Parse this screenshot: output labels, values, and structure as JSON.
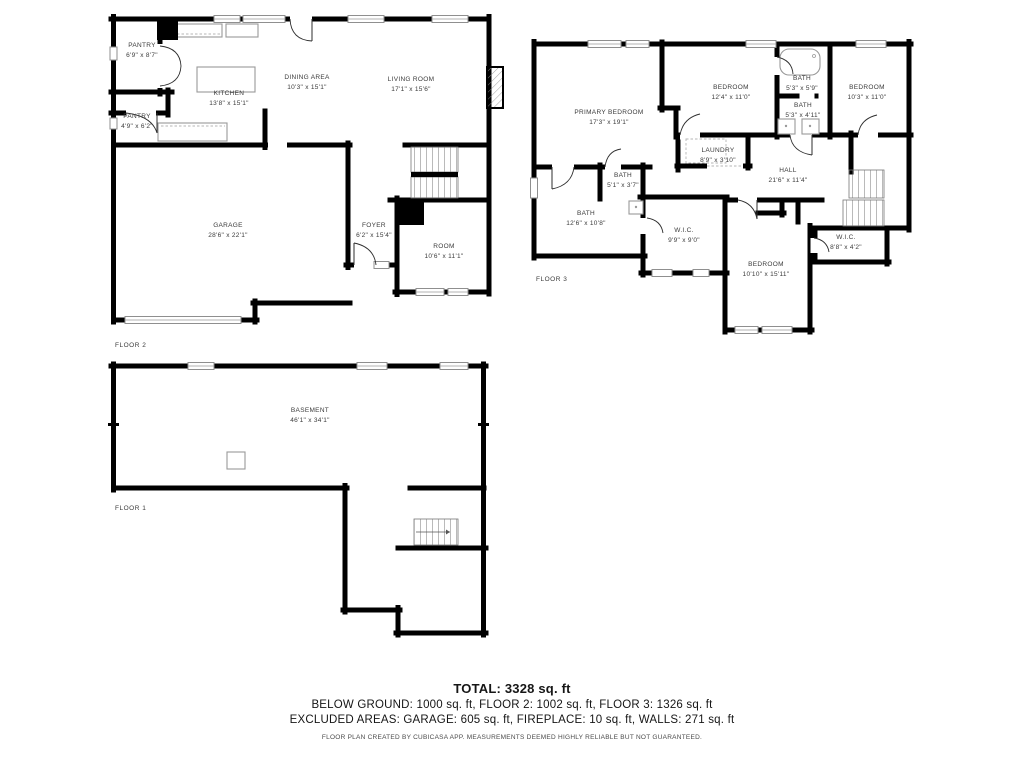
{
  "floors": [
    {
      "label": "FLOOR 2",
      "rooms": [
        {
          "name": "PANTRY",
          "dims": "6'9\" x 8'7\""
        },
        {
          "name": "PANTRY",
          "dims": "4'9\" x 6'2\""
        },
        {
          "name": "KITCHEN",
          "dims": "13'8\" x 15'1\""
        },
        {
          "name": "DINING AREA",
          "dims": "10'3\" x 15'1\""
        },
        {
          "name": "LIVING ROOM",
          "dims": "17'1\" x 15'6\""
        },
        {
          "name": "GARAGE",
          "dims": "28'6\" x 22'1\""
        },
        {
          "name": "FOYER",
          "dims": "6'2\" x 15'4\""
        },
        {
          "name": "ROOM",
          "dims": "10'6\" x 11'1\""
        }
      ]
    },
    {
      "label": "FLOOR 3",
      "rooms": [
        {
          "name": "PRIMARY BEDROOM",
          "dims": "17'3\" x 19'1\""
        },
        {
          "name": "BEDROOM",
          "dims": "12'4\" x 11'0\""
        },
        {
          "name": "BATH",
          "dims": "5'3\" x 5'9\""
        },
        {
          "name": "BATH",
          "dims": "5'3\" x 4'11\""
        },
        {
          "name": "BEDROOM",
          "dims": "10'3\" x 11'0\""
        },
        {
          "name": "LAUNDRY",
          "dims": "8'9\" x 3'10\""
        },
        {
          "name": "HALL",
          "dims": "21'6\" x 11'4\""
        },
        {
          "name": "BATH",
          "dims": "5'1\" x 3'7\""
        },
        {
          "name": "BATH",
          "dims": "12'6\" x 10'8\""
        },
        {
          "name": "W.I.C.",
          "dims": "9'9\" x 9'0\""
        },
        {
          "name": "BEDROOM",
          "dims": "10'10\" x 15'11\""
        },
        {
          "name": "W.I.C.",
          "dims": "8'8\" x 4'2\""
        }
      ]
    },
    {
      "label": "FLOOR 1",
      "rooms": [
        {
          "name": "BASEMENT",
          "dims": "46'1\" x 34'1\""
        }
      ]
    }
  ],
  "summary": {
    "total": "TOTAL: 3328 sq. ft",
    "floors_line": "BELOW GROUND: 1000 sq. ft, FLOOR 2: 1002 sq. ft, FLOOR 3: 1326 sq. ft",
    "excluded_line": "EXCLUDED AREAS: GARAGE: 605 sq. ft, FIREPLACE: 10 sq. ft, WALLS: 271 sq. ft"
  },
  "disclaimer": "FLOOR PLAN CREATED BY CUBICASA APP. MEASUREMENTS DEEMED HIGHLY RELIABLE BUT NOT GUARANTEED.",
  "colors": {
    "wall": "#000000",
    "fixture_outline": "#999999",
    "label_text": "#3b3b3b"
  }
}
